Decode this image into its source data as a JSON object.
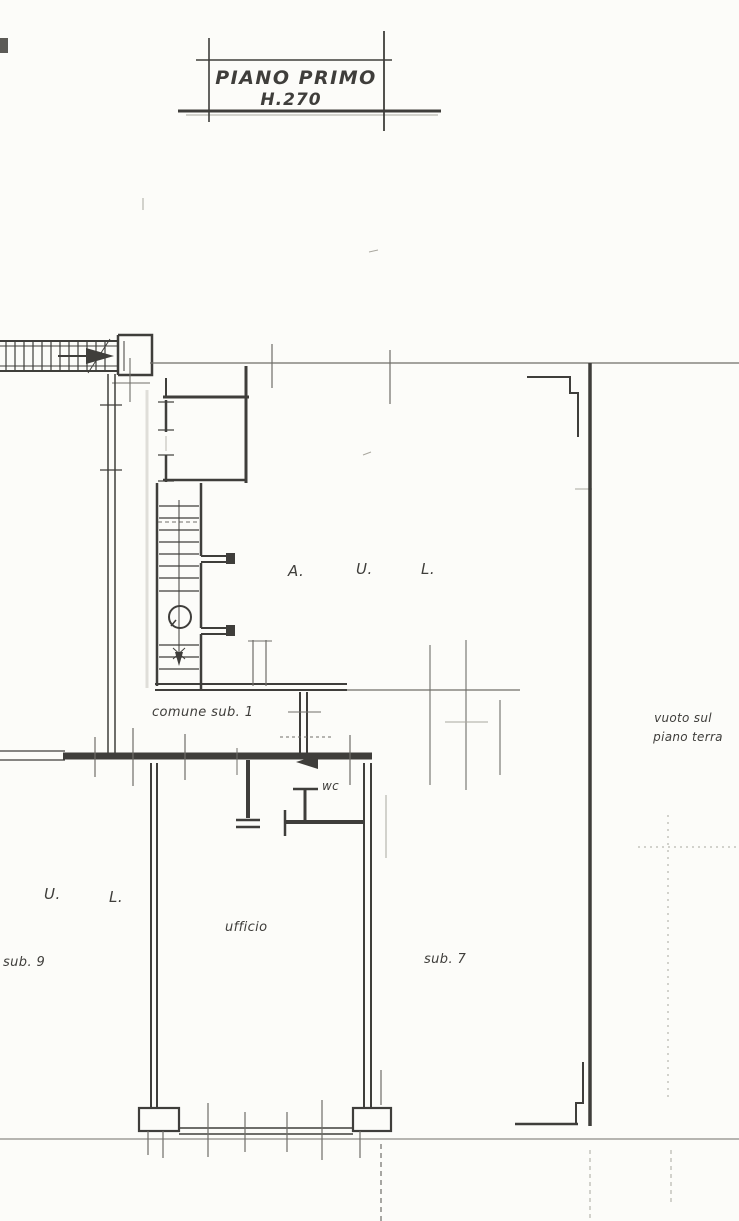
{
  "sheet": {
    "colors": {
      "paper": "#fcfcf9",
      "ink": "#3f3e3b",
      "soft": "#6f6e69",
      "faint": "#a9a79f"
    }
  },
  "title_block": {
    "line1": "PIANO PRIMO",
    "line2": "H.270"
  },
  "rooms": {
    "aul": {
      "letters": [
        "A.",
        "U.",
        "L."
      ]
    },
    "comune": "comune sub. 1",
    "vuoto": {
      "line1": "vuoto sul",
      "line2": "piano terra"
    },
    "wc": "wc",
    "ufficio": "ufficio",
    "sub7": "sub. 7",
    "ul_left": {
      "letters": [
        "U.",
        "L."
      ]
    },
    "sub9": "sub. 9"
  }
}
